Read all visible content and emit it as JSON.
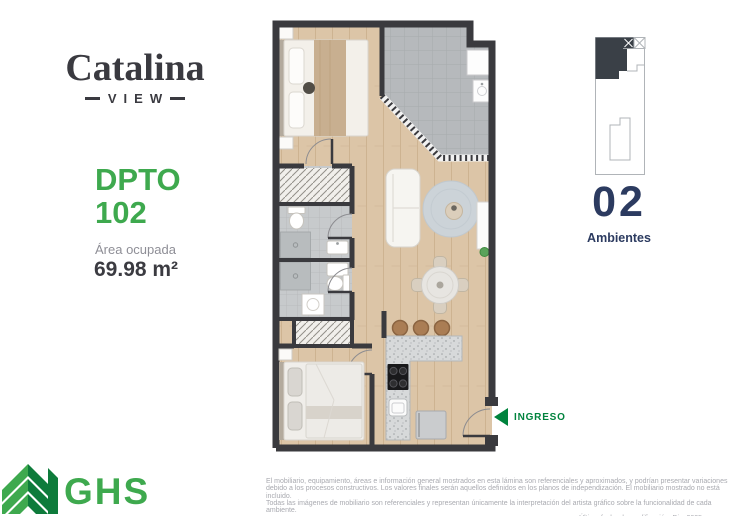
{
  "brand": {
    "name": "Catalina",
    "sub": "VIEW"
  },
  "unit": {
    "label": "DPTO",
    "number": "102",
    "area_caption": "Área ocupada",
    "area_value": "69.98 m²"
  },
  "keyplan": {
    "count": "02",
    "count_label": "Ambientes"
  },
  "plan": {
    "entry_label": "INGRESO"
  },
  "footer": {
    "logo_text": "GHS",
    "disclaimer": [
      "El mobiliario, equipamiento, áreas e información general mostrados en esta lámina son referenciales y aproximados, y podrían presentar variaciones",
      "debido a los procesos constructivos. Los valores finales serán aquellos definidos en los planos de independización. El mobiliario mostrado no está incluido.",
      "Todas las imágenes de mobiliario son referenciales y representan únicamente la interpretación del artista gráfico sobre la funcionalidad de cada ambiente.",
      "Última fecha de modificación: Dic. 2025."
    ]
  },
  "colors": {
    "brand_green": "#3EA94E",
    "logo_dark_green": "#0E7B3B",
    "ingreso_green": "#00833D",
    "navy": "#2C3B60",
    "text_dark": "#3b3b41",
    "text_gray": "#8e8e96",
    "wall": "#3a3a3e",
    "wood_floor": "#dcc5a7",
    "terrace_tile": "#b6b9bc",
    "bath_tile": "#c7cacc"
  }
}
